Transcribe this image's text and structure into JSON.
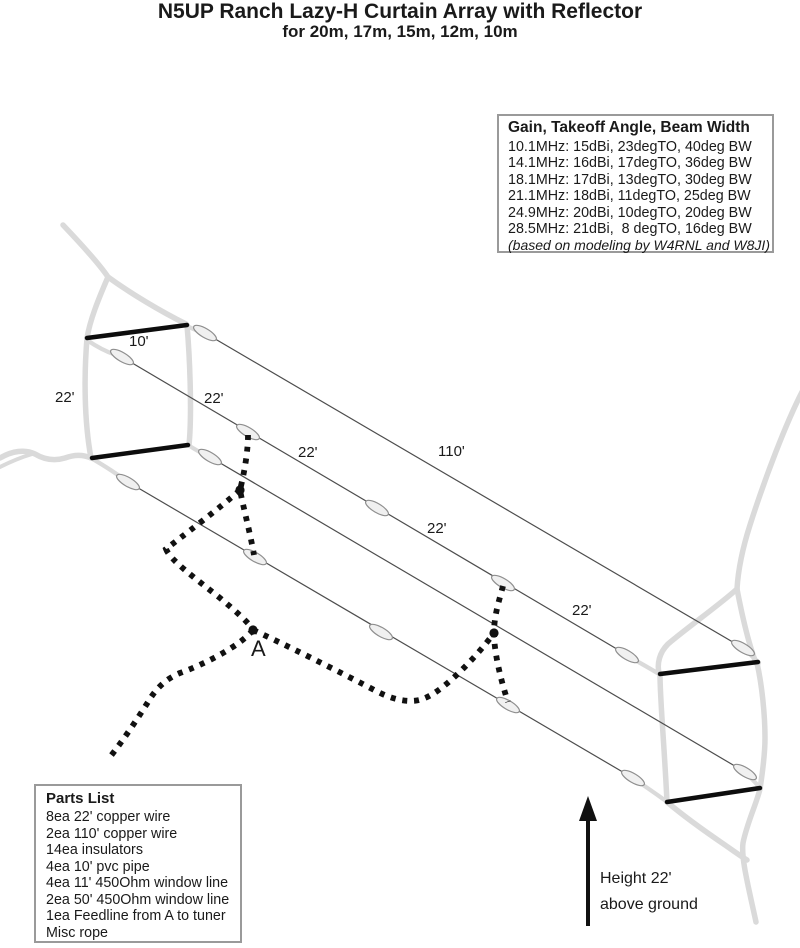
{
  "title": "N5UP Ranch Lazy-H Curtain Array with Reflector",
  "subtitle": "for 20m, 17m, 15m, 12m, 10m",
  "gain_box": {
    "title": "Gain, Takeoff Angle, Beam Width",
    "rows": [
      "10.1MHz: 15dBi, 23degTO, 40deg BW",
      "14.1MHz: 16dBi, 17degTO, 36deg BW",
      "18.1MHz: 17dBi, 13degTO, 30deg BW",
      "21.1MHz: 18dBi, 11degTO, 25deg BW",
      "24.9MHz: 20dBi, 10degTO, 20deg BW",
      "28.5MHz: 21dBi,  8 degTO, 16deg BW"
    ],
    "footnote": "(based on modeling by W4RNL and W8JI)"
  },
  "parts_box": {
    "title": "Parts List",
    "items": [
      "8ea 22' copper wire",
      "2ea 110' copper wire",
      "14ea insulators",
      "4ea 10' pvc pipe",
      "4ea 11' 450Ohm window line",
      "2ea 50' 450Ohm window line",
      "1ea Feedline from A to tuner",
      "Misc rope"
    ]
  },
  "diagram": {
    "labels": {
      "spreader_length": "10'",
      "left_height": "22'",
      "segment_1": "22'",
      "segment_2": "22'",
      "reflector_length": "110'",
      "segment_3": "22'",
      "segment_4": "22'"
    },
    "feed_point": "A",
    "height_note_line1": "Height 22'",
    "height_note_line2": "above ground",
    "insulator_count": 14
  },
  "colors": {
    "ink": "#1a1a1a",
    "wire": "#4d4d4d",
    "rope_tree": "#dadada",
    "insulator_fill": "#f0f0f0",
    "box_border": "#9a9a9a"
  }
}
